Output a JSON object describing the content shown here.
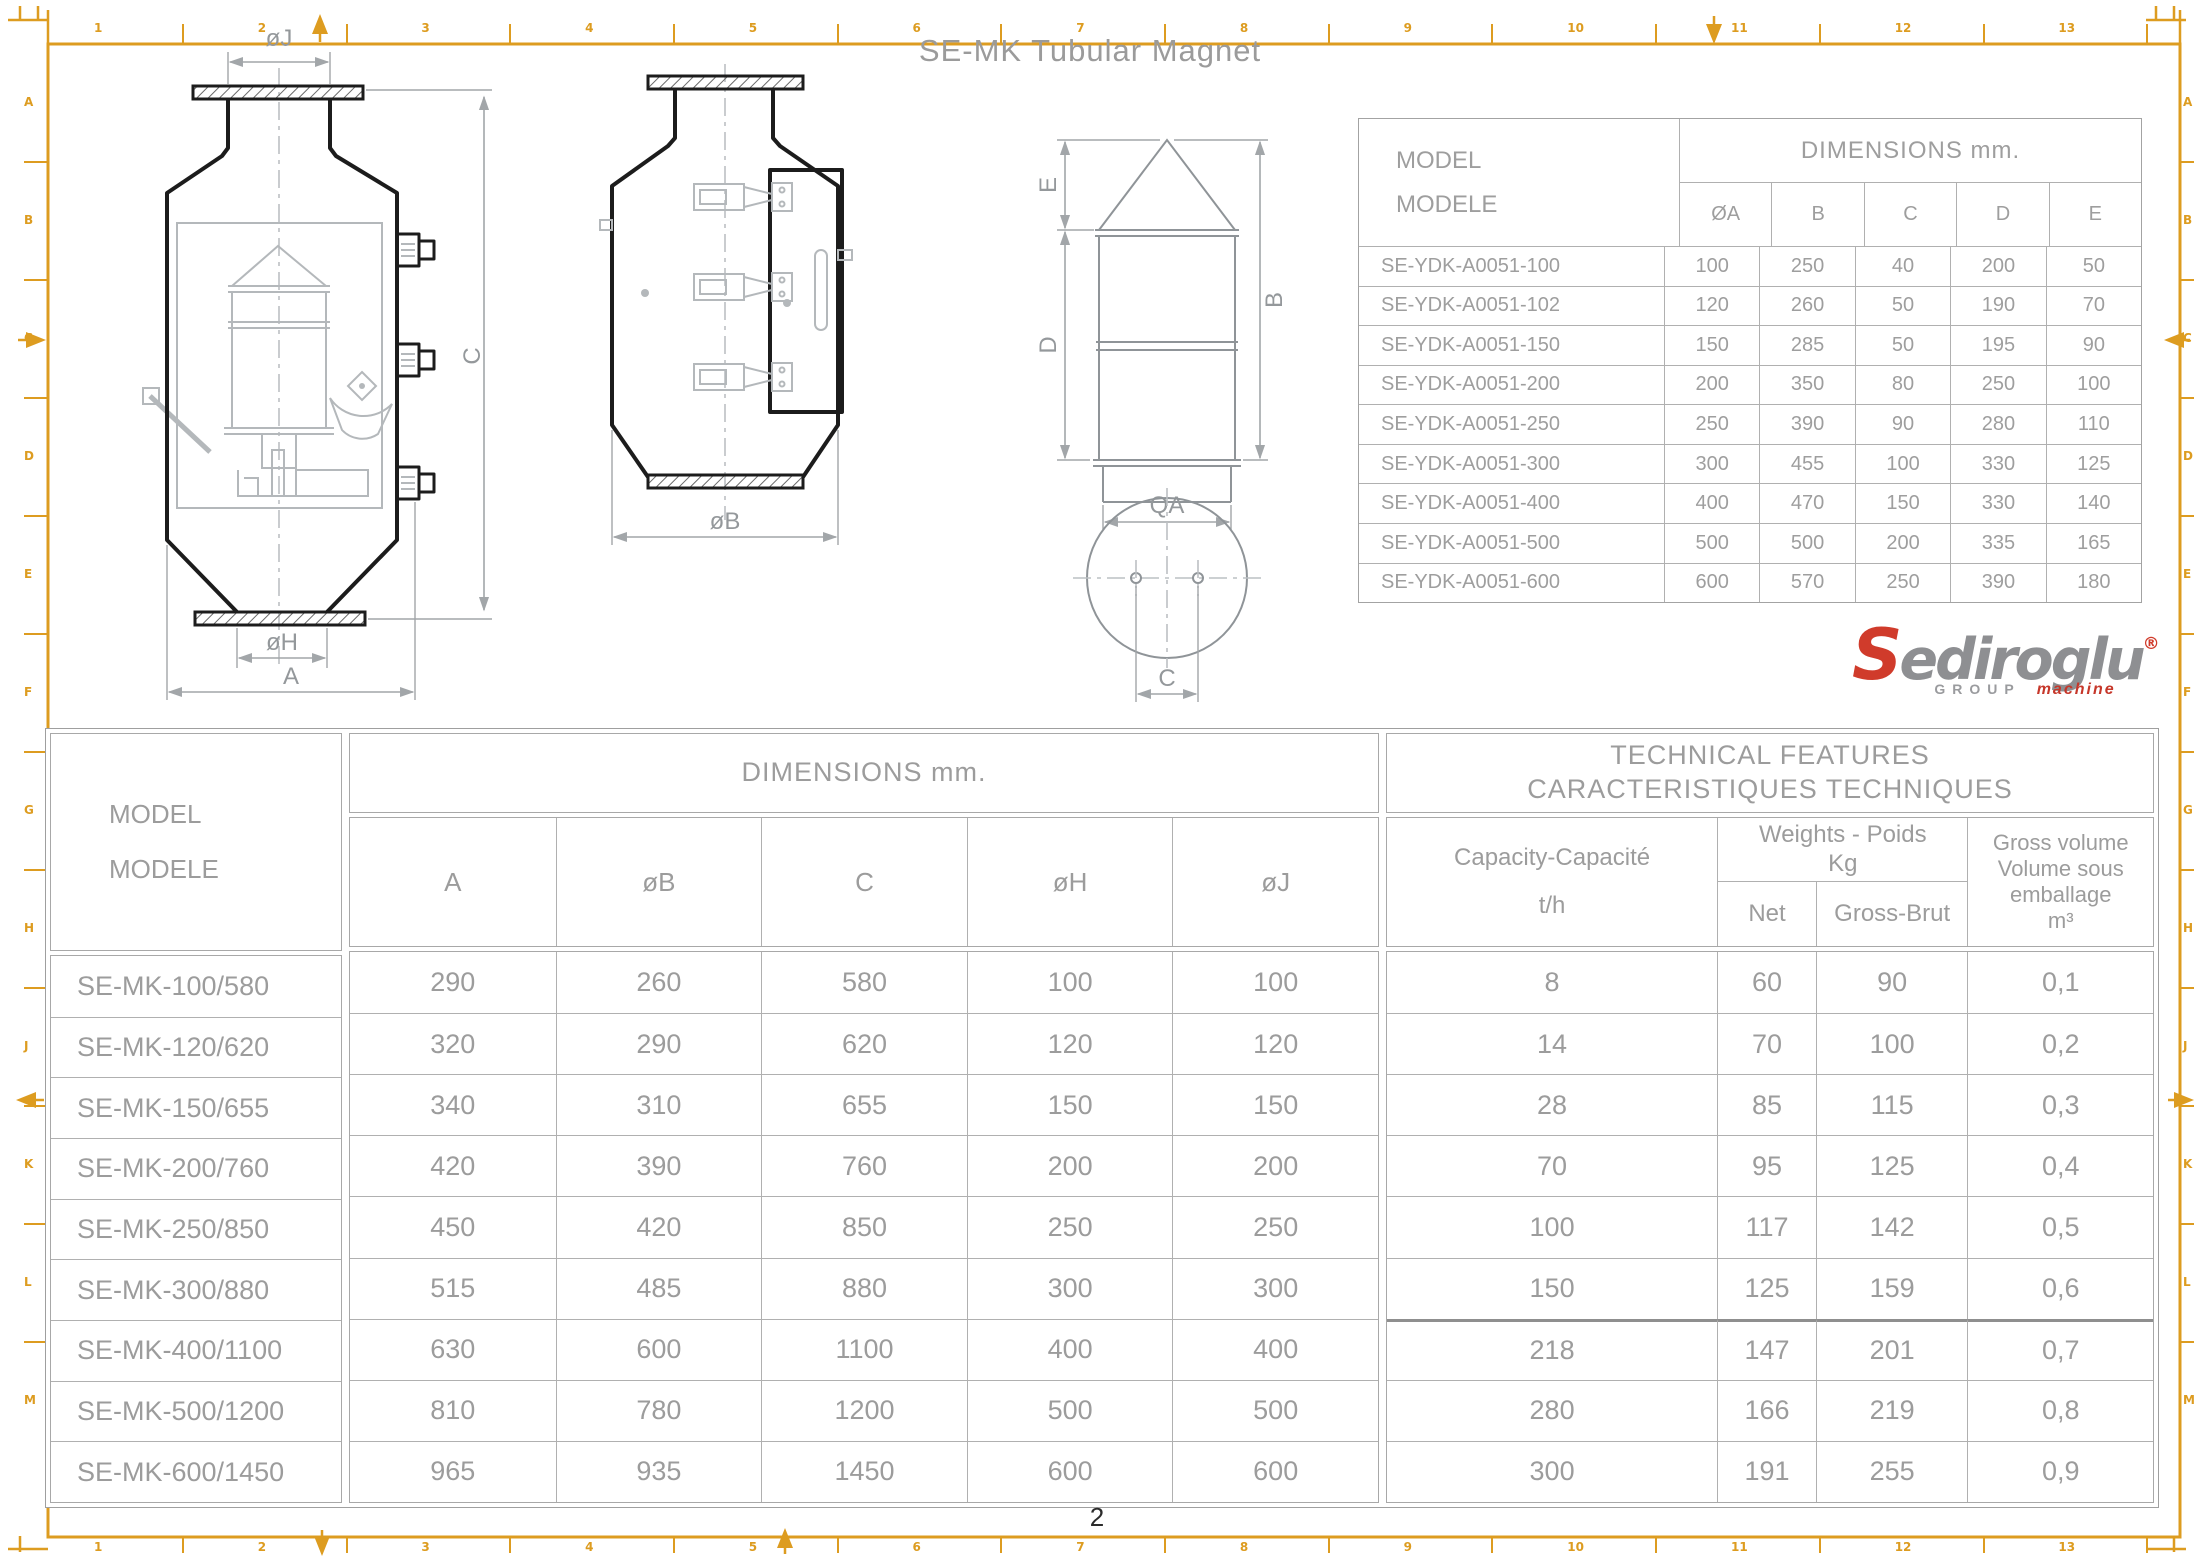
{
  "page": {
    "title": "SE-MK Tubular Magnet",
    "page_number": "2"
  },
  "frame": {
    "h_zones": [
      "1",
      "2",
      "3",
      "4",
      "5",
      "6",
      "7",
      "8",
      "9",
      "10",
      "11",
      "12",
      "13"
    ],
    "v_zones": [
      "A",
      "B",
      "C",
      "D",
      "E",
      "F",
      "G",
      "H",
      "J",
      "K",
      "L",
      "M"
    ],
    "accent_color": "#dd9c20"
  },
  "drawings": {
    "front": {
      "oj": "øJ",
      "c": "C",
      "oh": "øH",
      "a": "A"
    },
    "side": {
      "ob": "øB"
    },
    "detail": {
      "e": "E",
      "d": "D",
      "b": "B",
      "qa": "QA",
      "c": "C"
    }
  },
  "logo": {
    "s": "S",
    "rest": "ediroglu",
    "registered": "®",
    "group": "GROUP",
    "machine": "machine",
    "red": "#d03b2b",
    "gray": "#8e8f92"
  },
  "top_table": {
    "header": {
      "model": "MODEL",
      "modele": "MODELE",
      "dimensions": "DIMENSIONS mm."
    },
    "columns": [
      "ØA",
      "B",
      "C",
      "D",
      "E"
    ],
    "rows": [
      {
        "model": "SE-YDK-A0051-100",
        "values": [
          "100",
          "250",
          "40",
          "200",
          "50"
        ]
      },
      {
        "model": "SE-YDK-A0051-102",
        "values": [
          "120",
          "260",
          "50",
          "190",
          "70"
        ]
      },
      {
        "model": "SE-YDK-A0051-150",
        "values": [
          "150",
          "285",
          "50",
          "195",
          "90"
        ]
      },
      {
        "model": "SE-YDK-A0051-200",
        "values": [
          "200",
          "350",
          "80",
          "250",
          "100"
        ]
      },
      {
        "model": "SE-YDK-A0051-250",
        "values": [
          "250",
          "390",
          "90",
          "280",
          "110"
        ]
      },
      {
        "model": "SE-YDK-A0051-300",
        "values": [
          "300",
          "455",
          "100",
          "330",
          "125"
        ]
      },
      {
        "model": "SE-YDK-A0051-400",
        "values": [
          "400",
          "470",
          "150",
          "330",
          "140"
        ]
      },
      {
        "model": "SE-YDK-A0051-500",
        "values": [
          "500",
          "500",
          "200",
          "335",
          "165"
        ]
      },
      {
        "model": "SE-YDK-A0051-600",
        "values": [
          "600",
          "570",
          "250",
          "390",
          "180"
        ]
      }
    ]
  },
  "bottom_table": {
    "header": {
      "model": "MODEL",
      "modele": "MODELE",
      "dimensions": "DIMENSIONS mm.",
      "technical_line1": "TECHNICAL FEATURES",
      "technical_line2": "CARACTERISTIQUES TECHNIQUES",
      "capacity_line1": "Capacity-Capacité",
      "capacity_line2": "t/h",
      "weights_line1": "Weights - Poids",
      "weights_line2": "Kg",
      "net": "Net",
      "gross": "Gross-Brut",
      "volume_line1": "Gross volume",
      "volume_line2": "Volume sous",
      "volume_line3": "emballage",
      "volume_line4": "m³"
    },
    "dim_columns": [
      "A",
      "øB",
      "C",
      "øH",
      "øJ"
    ],
    "rows": [
      {
        "model": "SE-MK-100/580",
        "dims": [
          "290",
          "260",
          "580",
          "100",
          "100"
        ],
        "capacity": "8",
        "net": "60",
        "gross": "90",
        "volume": "0,1"
      },
      {
        "model": "SE-MK-120/620",
        "dims": [
          "320",
          "290",
          "620",
          "120",
          "120"
        ],
        "capacity": "14",
        "net": "70",
        "gross": "100",
        "volume": "0,2"
      },
      {
        "model": "SE-MK-150/655",
        "dims": [
          "340",
          "310",
          "655",
          "150",
          "150"
        ],
        "capacity": "28",
        "net": "85",
        "gross": "115",
        "volume": "0,3"
      },
      {
        "model": "SE-MK-200/760",
        "dims": [
          "420",
          "390",
          "760",
          "200",
          "200"
        ],
        "capacity": "70",
        "net": "95",
        "gross": "125",
        "volume": "0,4"
      },
      {
        "model": "SE-MK-250/850",
        "dims": [
          "450",
          "420",
          "850",
          "250",
          "250"
        ],
        "capacity": "100",
        "net": "117",
        "gross": "142",
        "volume": "0,5"
      },
      {
        "model": "SE-MK-300/880",
        "dims": [
          "515",
          "485",
          "880",
          "300",
          "300"
        ],
        "capacity": "150",
        "net": "125",
        "gross": "159",
        "volume": "0,6"
      },
      {
        "model": "SE-MK-400/1100",
        "dims": [
          "630",
          "600",
          "1100",
          "400",
          "400"
        ],
        "capacity": "218",
        "net": "147",
        "gross": "201",
        "volume": "0,7"
      },
      {
        "model": "SE-MK-500/1200",
        "dims": [
          "810",
          "780",
          "1200",
          "500",
          "500"
        ],
        "capacity": "280",
        "net": "166",
        "gross": "219",
        "volume": "0,8"
      },
      {
        "model": "SE-MK-600/1450",
        "dims": [
          "965",
          "935",
          "1450",
          "600",
          "600"
        ],
        "capacity": "300",
        "net": "191",
        "gross": "255",
        "volume": "0,9"
      }
    ]
  }
}
